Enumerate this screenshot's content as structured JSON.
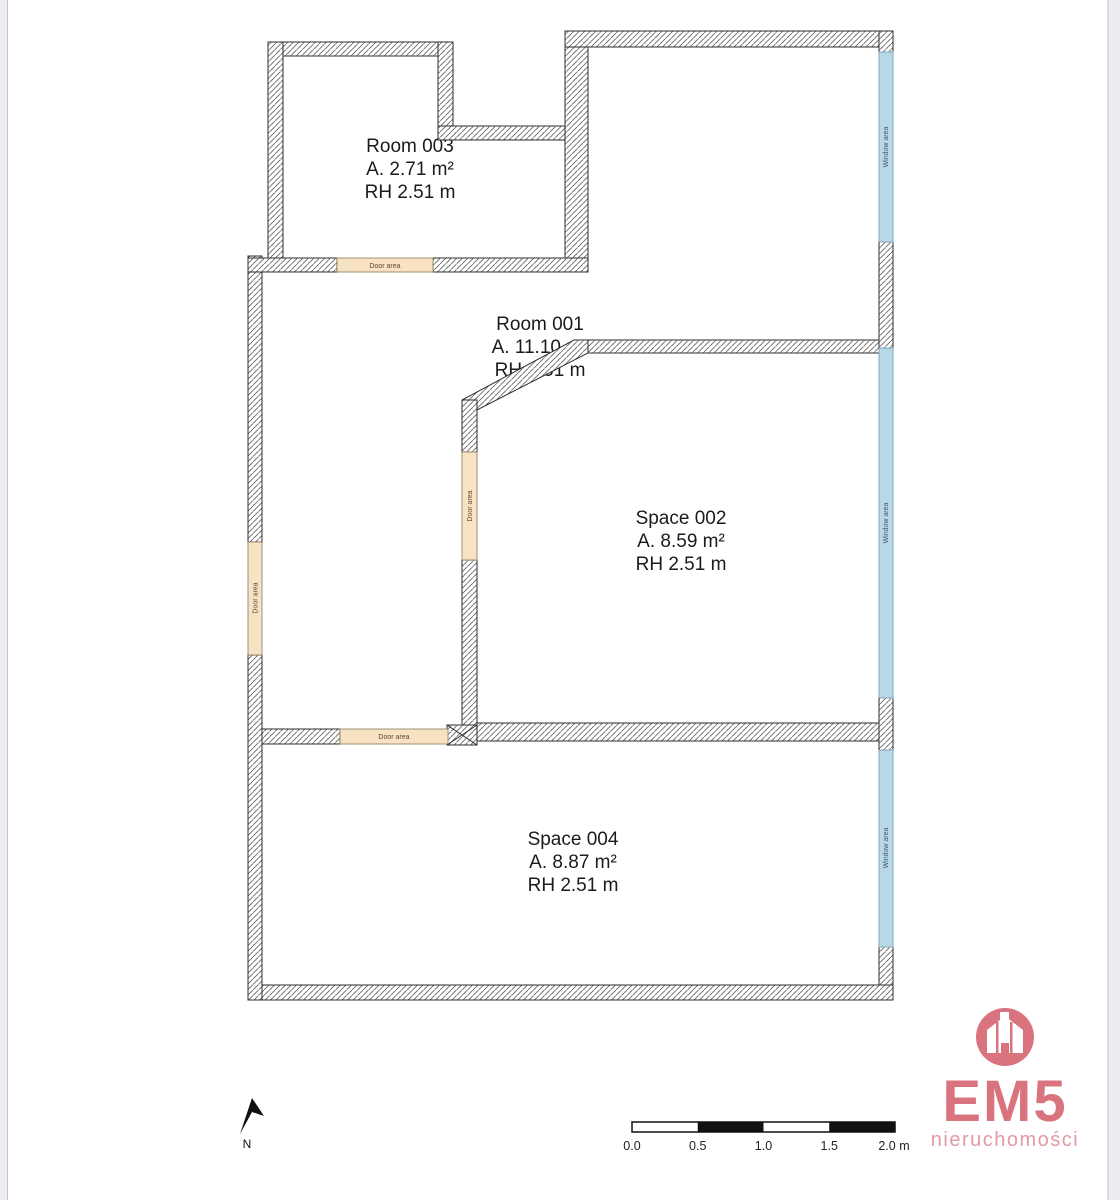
{
  "rooms": [
    {
      "name": "Room 003",
      "area": "A. 2.71 m²",
      "height": "RH 2.51 m"
    },
    {
      "name": "Room 001",
      "area": "A. 11.10 m²",
      "height": "RH 2.51 m"
    },
    {
      "name": "Space 002",
      "area": "A. 8.59 m²",
      "height": "RH 2.51 m"
    },
    {
      "name": "Space 004",
      "area": "A. 8.87 m²",
      "height": "RH 2.51 m"
    }
  ],
  "labels": {
    "door": "Door area",
    "window": "Window area"
  },
  "north": {
    "label": "N"
  },
  "scale_bar": {
    "ticks": [
      "0.0",
      "0.5",
      "1.0",
      "1.5",
      "2.0 m"
    ]
  },
  "logo": {
    "title": "EM5",
    "subtitle": "nieruchomości"
  },
  "colors": {
    "wall_outline": "#2e2e2e",
    "wall_hatch": "#606060",
    "window_fill": "#b9d8e6",
    "window_border": "#7fa9bd",
    "window_text": "#3c5a6e",
    "door_fill": "#f7e3c4",
    "door_border": "#8c7a55",
    "door_text": "#5f4a32",
    "logo_pink": "#d9747f",
    "logo_pink_light": "#e39aa3",
    "scale_black": "#111111",
    "edge_strip": "#ededf1"
  }
}
